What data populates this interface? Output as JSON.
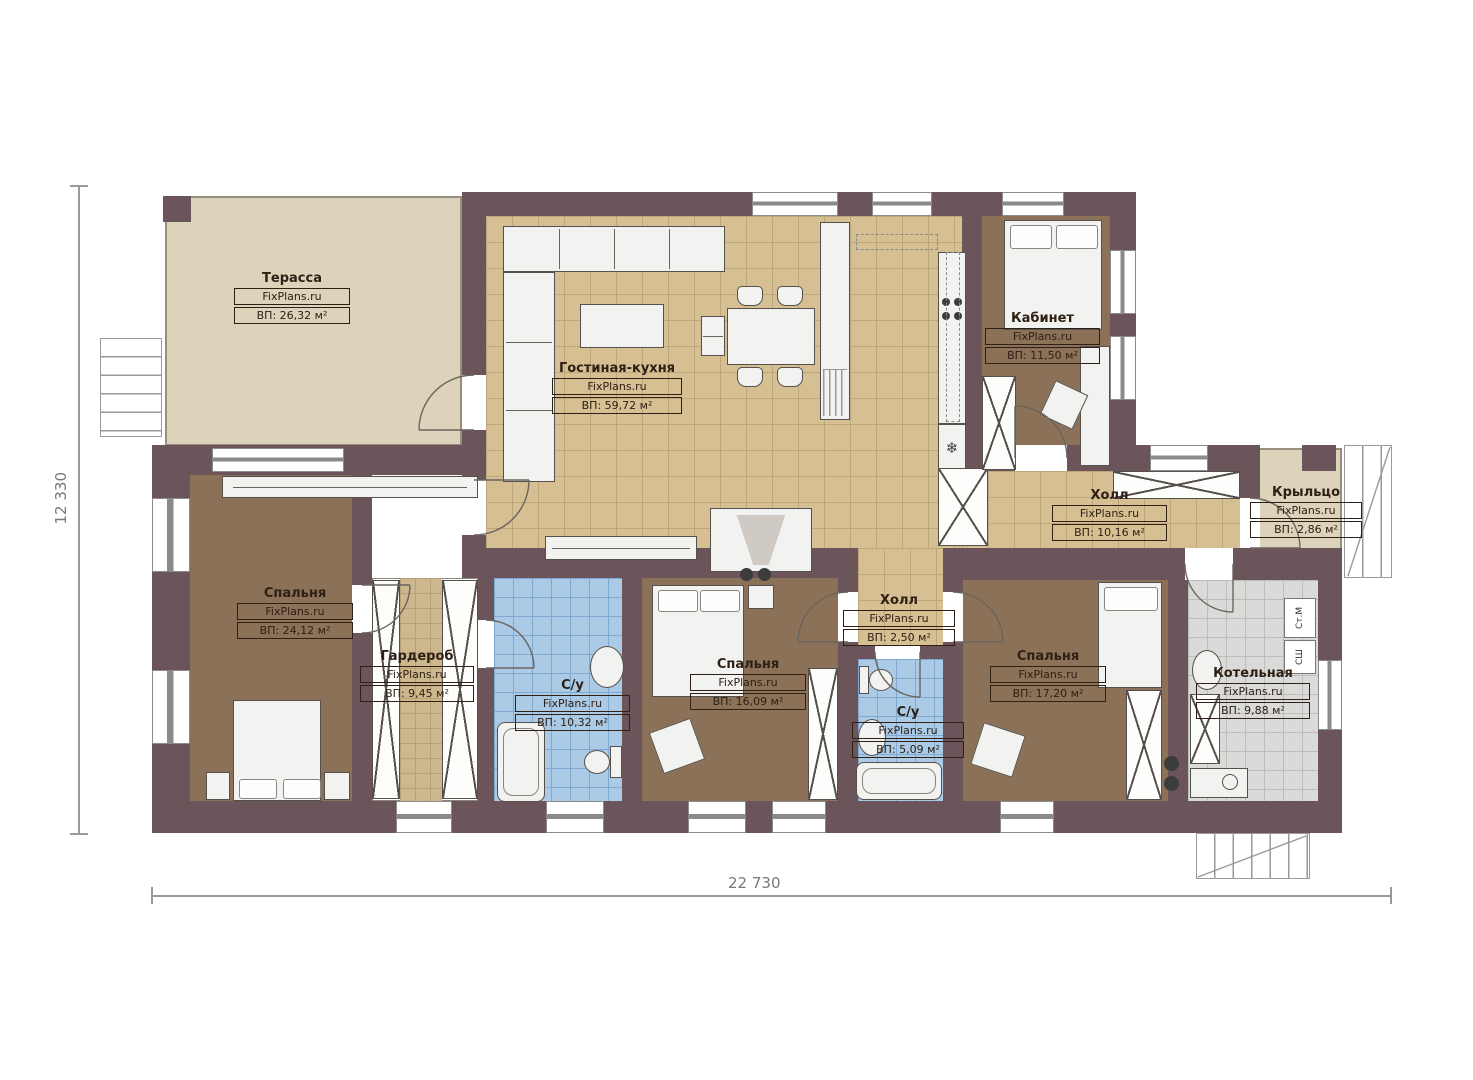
{
  "plan": {
    "title": "Floor plan (single storey house)",
    "watermark": "FixPlans.ru",
    "dimensions": {
      "height_label": "12 330",
      "width_label": "22 730"
    },
    "rooms": [
      {
        "name": "Терасса",
        "watermark": "FixPlans.ru",
        "area": "ВП: 26,32 м²"
      },
      {
        "name": "Гостиная-кухня",
        "watermark": "FixPlans.ru",
        "area": "ВП: 59,72 м²"
      },
      {
        "name": "Кабинет",
        "watermark": "FixPlans.ru",
        "area": "ВП: 11,50 м²"
      },
      {
        "name": "Холл",
        "watermark": "FixPlans.ru",
        "area": "ВП: 10,16 м²"
      },
      {
        "name": "Крыльцо",
        "watermark": "FixPlans.ru",
        "area": "ВП: 2,86 м²"
      },
      {
        "name": "Спальня",
        "watermark": "FixPlans.ru",
        "area": "ВП: 24,12 м²"
      },
      {
        "name": "Гардероб",
        "watermark": "FixPlans.ru",
        "area": "ВП: 9,45 м²"
      },
      {
        "name": "С/у",
        "watermark": "FixPlans.ru",
        "area": "ВП: 10,32 м²"
      },
      {
        "name": "Спальня",
        "watermark": "FixPlans.ru",
        "area": "ВП: 16,09 м²"
      },
      {
        "name": "Холл",
        "watermark": "FixPlans.ru",
        "area": "ВП: 2,50 м²"
      },
      {
        "name": "С/у",
        "watermark": "FixPlans.ru",
        "area": "ВП: 5,09 м²"
      },
      {
        "name": "Спальня",
        "watermark": "FixPlans.ru",
        "area": "ВП: 17,20 м²"
      },
      {
        "name": "Котельная",
        "watermark": "FixPlans.ru",
        "area": "ВП: 9,88 м²"
      }
    ],
    "appliances": {
      "washer": "Ст.М",
      "dryer": "СШ"
    },
    "fridge_glyph": "❄",
    "colors": {
      "wall": "#6c555a",
      "terrace": "#dcd3ba",
      "tile_living": "#d5bf93",
      "tile_grid": "#bca77b",
      "room_brown": "#8a7157",
      "tile_blue": "#abcae6",
      "tile_blue_grid": "#80a9d1",
      "tile_gray": "#dadad8",
      "tile_gray_grid": "#bcbcba",
      "ward_tile": "#cdb78c",
      "ward_grid": "#b7a178",
      "furniture": "#f2f2f0",
      "outline": "#55504b",
      "label": "#2e2014",
      "dim": "#9a9a9a"
    }
  }
}
